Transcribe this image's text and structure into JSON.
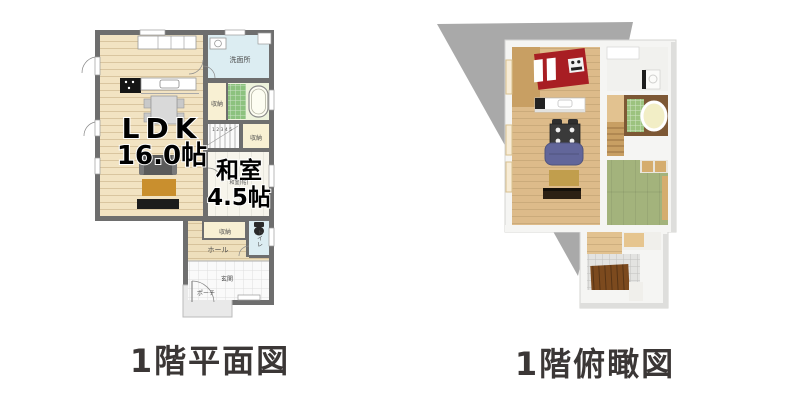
{
  "page": {
    "background": "#ffffff",
    "description": "Two Japanese house floor plans side by side"
  },
  "captions": {
    "left": "1階平面図",
    "right": "1階俯瞰図"
  },
  "left_plan": {
    "type": "2d-floor-plan",
    "labels": {
      "ldk": "LDK",
      "ldk_size": "16.0帖",
      "washitsu": "和室",
      "washitsu_small": "和室(帖)",
      "washitsu_size": "4.5帖",
      "senmenjo": "洗面所",
      "closet_bath": "収納",
      "closet_stairs": "収納",
      "closet_washitsu": "収納",
      "toilet": "トイレ",
      "hall": "ホール",
      "genkan": "玄関",
      "porch": "ポーチ",
      "stair_numbers": "1 2 3 4 5"
    }
  },
  "right_plan": {
    "type": "3d-overhead-view",
    "rooms": [
      "kitchen",
      "washroom",
      "bathroom",
      "stairs",
      "tatami-room",
      "living-room",
      "hall",
      "entrance"
    ]
  },
  "palette": {
    "caption_color": "#3b3736",
    "wall_gray": "#6e6e6e",
    "floor_wood": "#f2e3c2",
    "hall_wood": "#eedfbc",
    "washroom_blue": "#dcedf2",
    "closet_cream": "#f8f0d3",
    "bath_floor": "#eef3dc",
    "bath_mat_green": "#8cc27e",
    "tatami_pale": "#f7f5ec",
    "tile_white": "#fafafa",
    "porch_gray": "#e9e9e9",
    "shadow_gray": "#a9a9a9",
    "wall_white": "#f5f5f3",
    "wood3d": "#ddbb8a",
    "wood3d_dark": "#c89f63",
    "kitchen_red": "#a81e23",
    "tatami_green": "#a3b37c",
    "sofa_purple": "#62669a",
    "rug_tan": "#c19e4d",
    "tv_dark": "#2c2013",
    "deck_brown": "#7c4a1e",
    "bath_green3d": "#9cc37f",
    "bath_wall_brown": "#7d5835",
    "tub_cream": "#f2eec6",
    "tile3d": "#e3e3e1",
    "rug2d_orange": "#c98f2e"
  }
}
